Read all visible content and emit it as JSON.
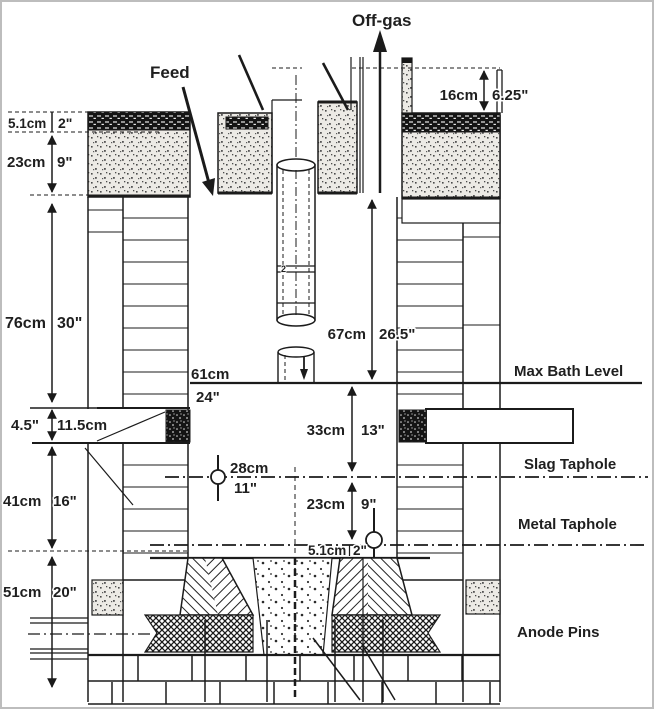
{
  "labels": {
    "off_gas": "Off-gas",
    "feed": "Feed",
    "max_bath_level": "Max Bath Level",
    "slag_taphole": "Slag Taphole",
    "metal_taphole": "Metal Taphole",
    "anode_pins": "Anode Pins"
  },
  "dims": {
    "duct": {
      "cm": "16cm",
      "in": "6.25\""
    },
    "roof_band": {
      "cm": "5.1cm",
      "in": "2\""
    },
    "upper_wall": {
      "cm": "23cm",
      "in": "9\""
    },
    "freeboard": {
      "cm": "76cm",
      "in": "30\""
    },
    "launder_slot": {
      "in": "4.5\"",
      "cm": "11.5cm"
    },
    "lower_wall": {
      "cm": "41cm",
      "in": "16\""
    },
    "hearth": {
      "cm": "51cm",
      "in": "20\""
    },
    "bath_width": {
      "cm": "61cm",
      "in": "24\""
    },
    "electrode": {
      "cm": "67cm",
      "in": "26.5\""
    },
    "slag_depth": {
      "cm": "33cm",
      "in": "13\""
    },
    "slag_hole": {
      "cm": "28cm",
      "in": "11\""
    },
    "metal_depth": {
      "cm": "23cm",
      "in": "9\""
    },
    "metal_hole": {
      "cm": "5.1cm",
      "in": "2\""
    },
    "electrode_mark": "2"
  }
}
